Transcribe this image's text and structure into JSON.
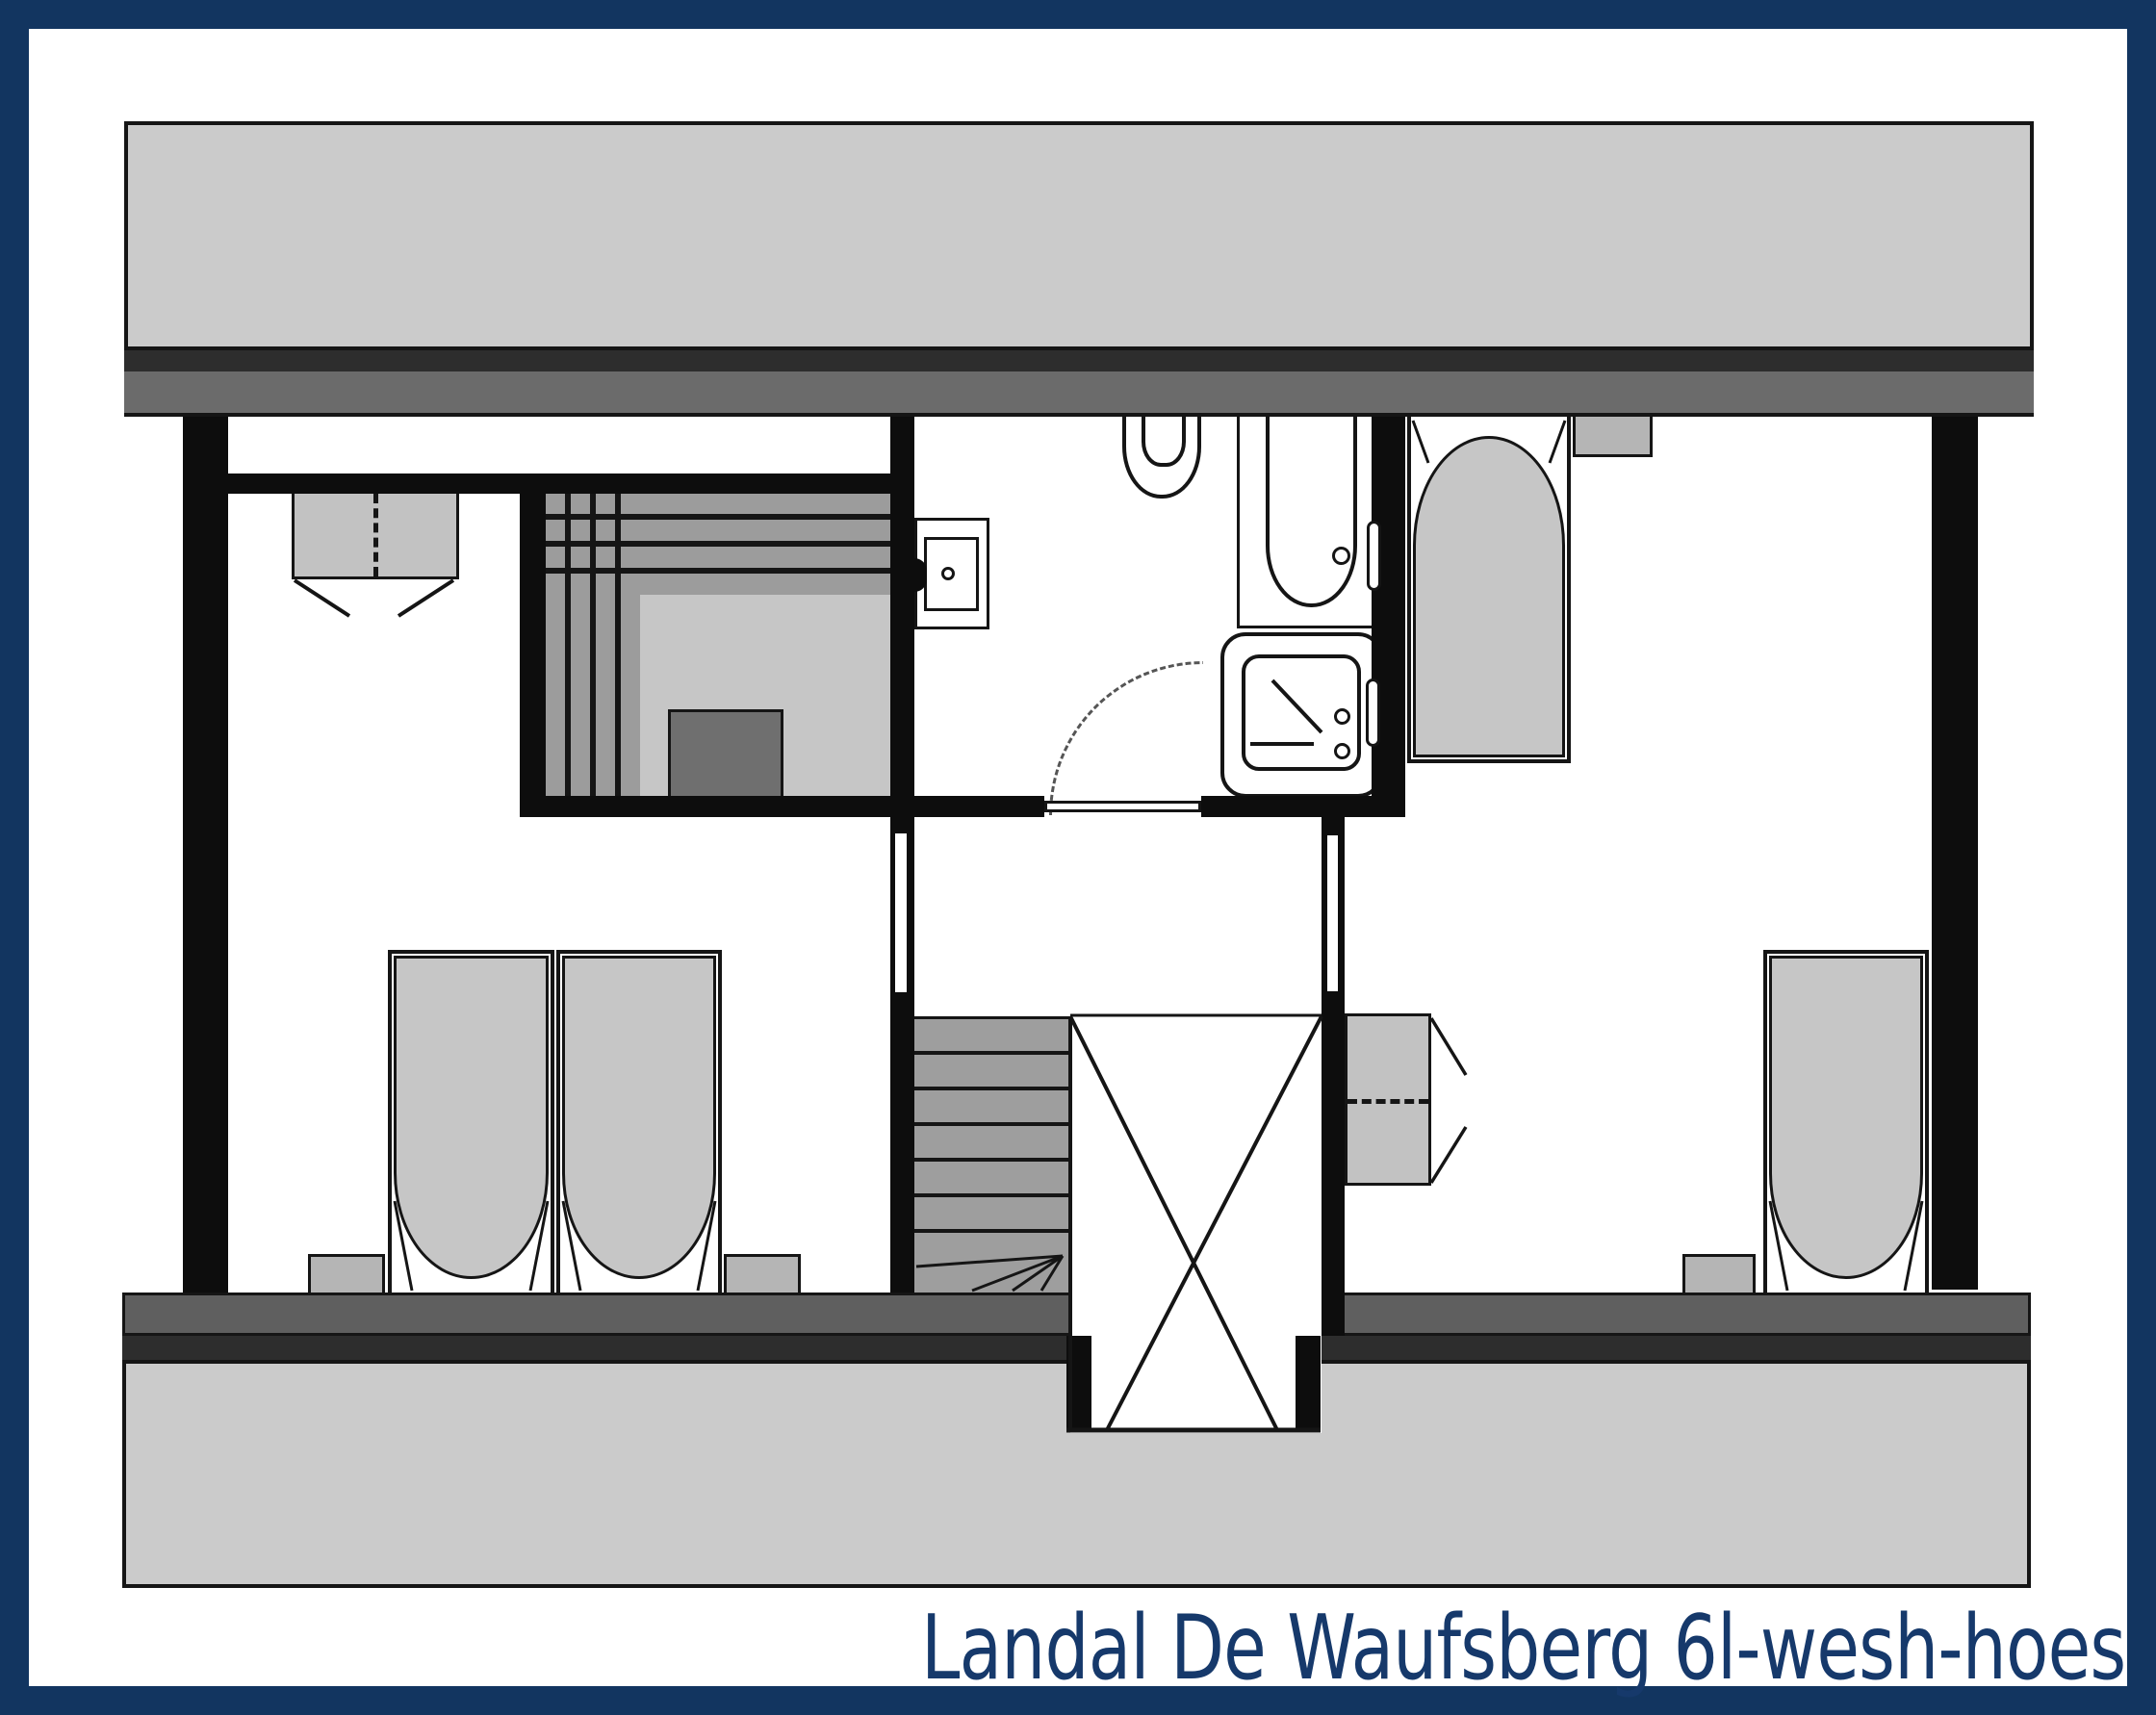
{
  "title": {
    "text": "Landal De Waufsberg 6l-wesh-hoes"
  },
  "colors": {
    "frame_navy": "#123560",
    "title_navy": "#16396b",
    "roof_light_gray": "#cbcbcb",
    "roof_dark_strip": "#2d2d2d",
    "eaves_mid_gray": "#6b6b6b",
    "wall_black": "#0d0d0d",
    "furniture_gray": "#c6c6c6",
    "bench_slat_gray": "#9c9c9c",
    "stair_tread_gray": "#9e9e9e",
    "stove_gray": "#6f6f6f",
    "small_furniture_gray": "#b5b5b5"
  },
  "floorplan": {
    "type": "holiday-home upper floor plan",
    "fixtures": [
      "roof-band-top",
      "roof-band-bottom",
      "left-bedroom",
      "right-bedroom",
      "sauna",
      "sauna-stove",
      "bathroom",
      "toilet",
      "bathtub",
      "washbasin",
      "shower",
      "staircase-with-winders",
      "stairwell-void",
      "double-wardrobe",
      "single-wardrobe",
      "single-bed-1",
      "single-bed-2",
      "single-bed-3",
      "single-bed-4",
      "nightstand-1",
      "nightstand-2",
      "nightstand-3",
      "wall-shelf",
      "bathroom-door",
      "door-swing-arc",
      "bedroom-door-left",
      "bedroom-door-right"
    ]
  }
}
